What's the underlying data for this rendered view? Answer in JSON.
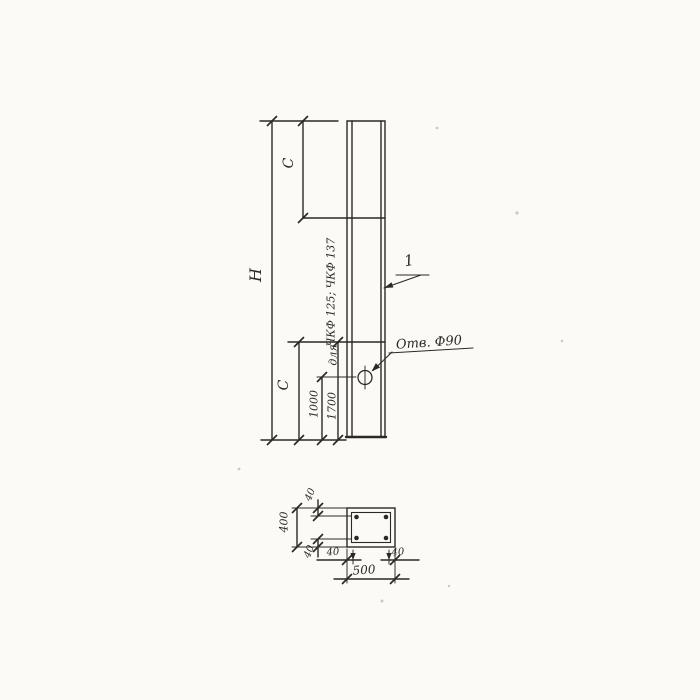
{
  "theme": {
    "ink": "#2b2923",
    "paper": "#fbfaf7",
    "speck": "#ccc9c0"
  },
  "elevation": {
    "dim_height": "H",
    "dim_top": "C",
    "dim_bottom": "C",
    "dim_hole_from_bottom": "1000",
    "dim_mark_from_bottom": "1700",
    "note_line1": "для",
    "note_line2": "ЧКФ 125; ЧКФ 137",
    "hole_callout": "Отв. Ф90",
    "part_tag": "1"
  },
  "section": {
    "dim_height": "400",
    "dim_width": "500",
    "dim_cover_top": "40",
    "dim_cover_bottom": "40",
    "dim_cover_left": "40",
    "dim_cover_right": "40"
  }
}
